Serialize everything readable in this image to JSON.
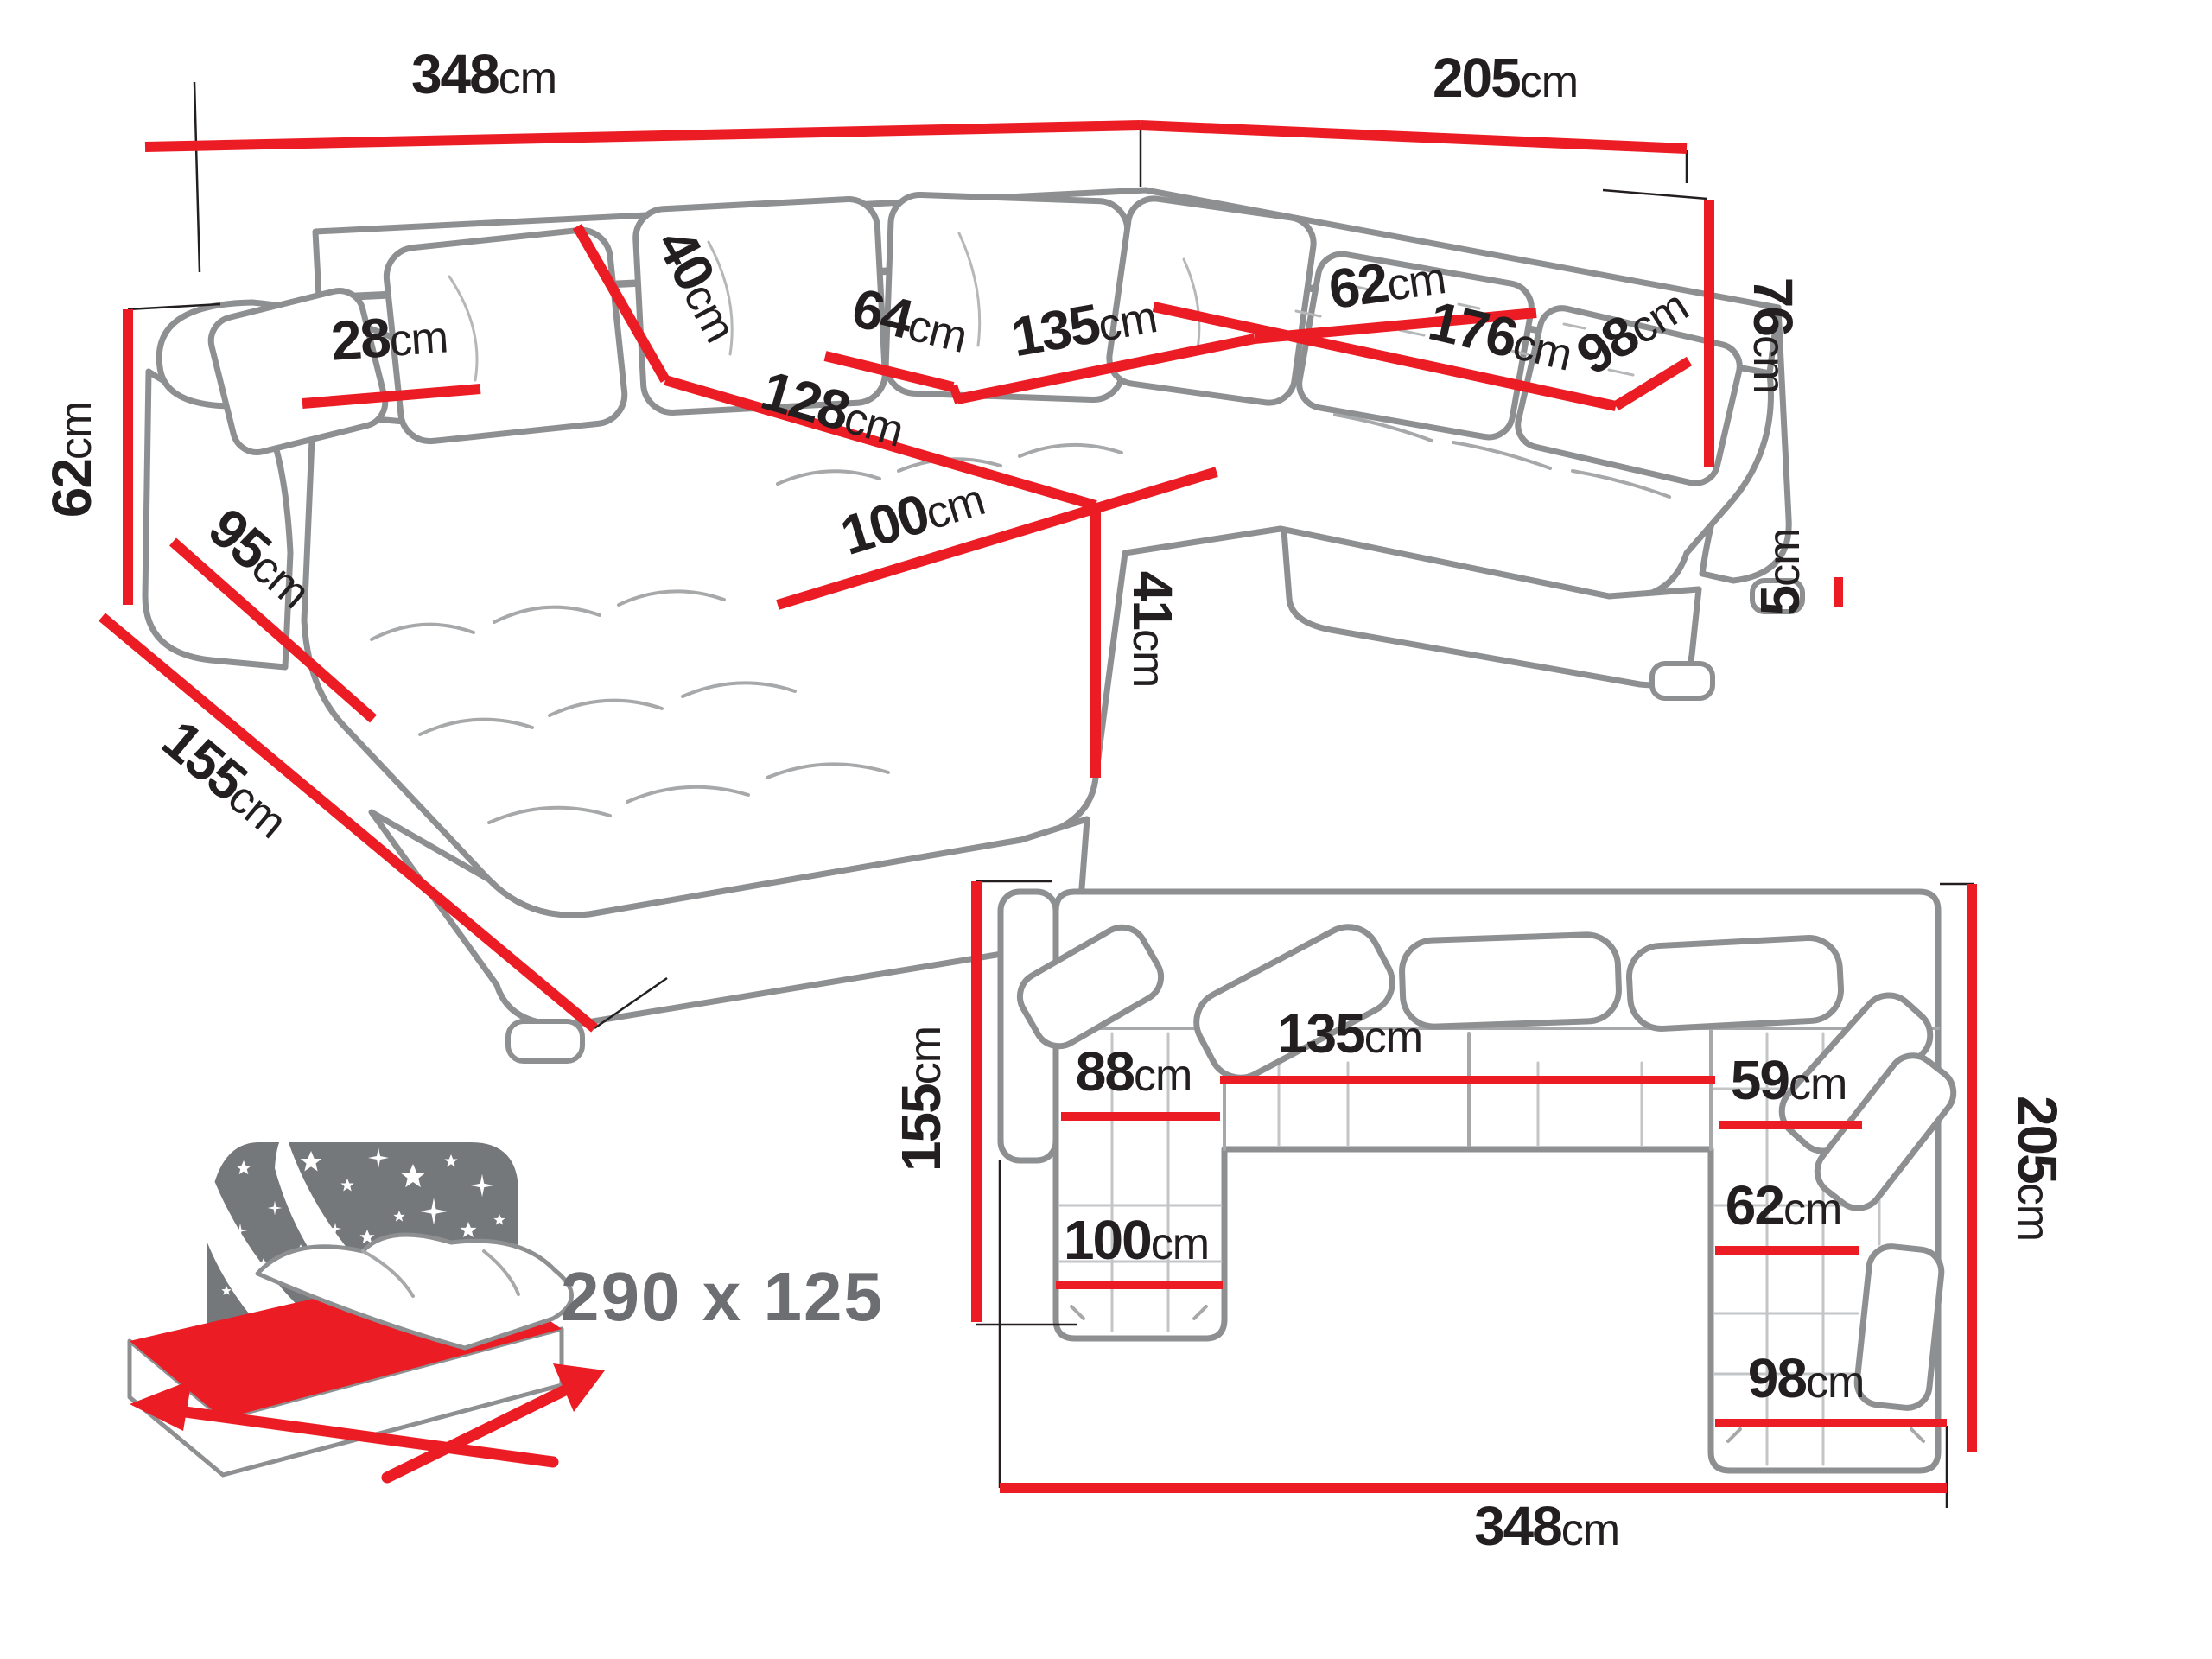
{
  "colors": {
    "dimension_red": "#ec1c24",
    "outline_gray": "#8d8f91",
    "label_black": "#231f20",
    "bed_icon_gray": "#75787b",
    "bed_text_gray": "#6d6e71"
  },
  "perspective_view": {
    "back_width_left": {
      "value": "348",
      "unit": "cm"
    },
    "back_width_right": {
      "value": "205",
      "unit": "cm"
    },
    "armrest_height": {
      "value": "62",
      "unit": "cm"
    },
    "chaise_total_depth": {
      "value": "155",
      "unit": "cm"
    },
    "armrest_length": {
      "value": "95",
      "unit": "cm"
    },
    "armrest_width": {
      "value": "28",
      "unit": "cm"
    },
    "backrest_height": {
      "value": "40",
      "unit": "cm"
    },
    "seat_depth_left": {
      "value": "64",
      "unit": "cm"
    },
    "middle_seat_width": {
      "value": "135",
      "unit": "cm"
    },
    "chaise_length": {
      "value": "128",
      "unit": "cm"
    },
    "chaise_width": {
      "value": "100",
      "unit": "cm"
    },
    "seat_height": {
      "value": "41",
      "unit": "cm"
    },
    "right_seat_depth": {
      "value": "62",
      "unit": "cm"
    },
    "right_seat_length": {
      "value": "176",
      "unit": "cm"
    },
    "right_end_width": {
      "value": "98",
      "unit": "cm"
    },
    "total_height": {
      "value": "76",
      "unit": "cm"
    },
    "leg_height": {
      "value": "5",
      "unit": "cm"
    }
  },
  "plan_view": {
    "left_depth": {
      "value": "155",
      "unit": "cm"
    },
    "right_depth": {
      "value": "205",
      "unit": "cm"
    },
    "total_width": {
      "value": "348",
      "unit": "cm"
    },
    "left_seat_width": {
      "value": "88",
      "unit": "cm"
    },
    "middle_seat_width": {
      "value": "135",
      "unit": "cm"
    },
    "right_seat_width": {
      "value": "59",
      "unit": "cm"
    },
    "right_inner_width": {
      "value": "62",
      "unit": "cm"
    },
    "left_chaise_width": {
      "value": "100",
      "unit": "cm"
    },
    "right_chaise_width": {
      "value": "98",
      "unit": "cm"
    }
  },
  "sleeping_area": {
    "label": "290 x 125"
  }
}
